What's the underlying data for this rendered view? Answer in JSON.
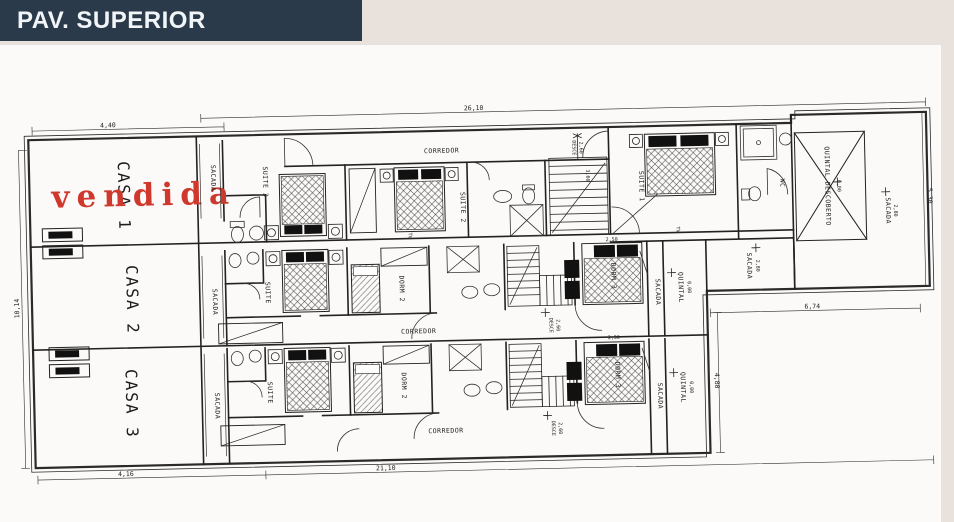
{
  "header": {
    "title": "PAV. SUPERIOR",
    "background": "#2a3a4b",
    "text_color": "#f2f5f7"
  },
  "stamp": {
    "text": "vendida",
    "color": "#cf382d"
  },
  "houses": [
    {
      "label": "CASA 1"
    },
    {
      "label": "CASA 2"
    },
    {
      "label": "CASA 3"
    }
  ],
  "rooms": {
    "corredor": "CORREDOR",
    "suite1": "SUITE 1",
    "suite2": "SUITE 2",
    "suite3": "SUITE 3",
    "suite": "SUITE",
    "dorm2": "DORM 2",
    "dorm3": "DORM 3",
    "wc": "WC",
    "sacada": "SACADA",
    "quintal": "QUINTAL",
    "quintal_descoberto": "QUINTAL DESCOBERTO",
    "desce": "DESCE",
    "tv": "TV"
  },
  "levels": {
    "sacada_280": "2,80",
    "quintal_000": "0,00",
    "desce_260": "2,60"
  },
  "dimensions": {
    "top_total": "26,10",
    "top_left": "4,40",
    "left_height": "10,14",
    "bottom_left": "4,16",
    "bottom_total": "21,10",
    "right_bottom": "6,74",
    "right_height": "5,30",
    "right_quintal": "4,80",
    "bed_width": "2,50",
    "stair_run": "3,60"
  }
}
